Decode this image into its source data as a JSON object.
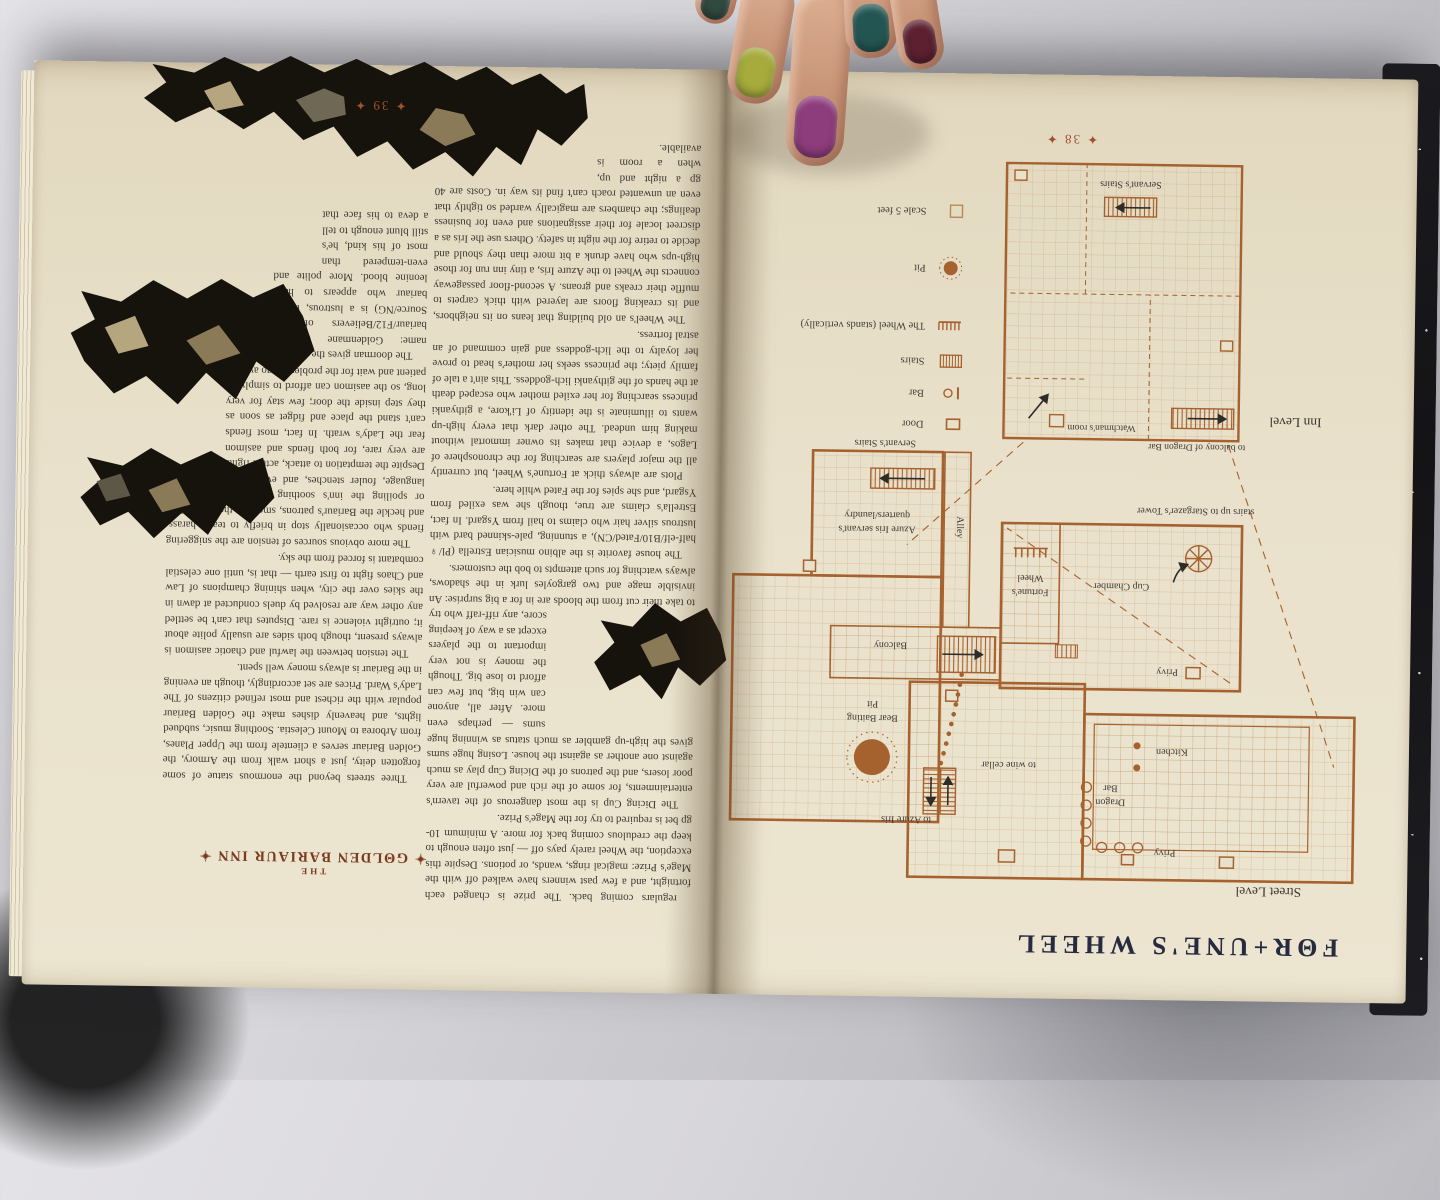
{
  "colors": {
    "page": "#e9e1cb",
    "map_ink": "#a5612e",
    "title_ink": "#262b40",
    "heading_ink": "#7a3a1f",
    "folio_ink": "#a0512e"
  },
  "page38": {
    "title": "FΘR+UNE'S WHEEL",
    "folio": "✦ 38 ✦",
    "street_map": {
      "caption": "Street Level",
      "labels": {
        "privy_top": "Privy",
        "kitchen": "Kitchen",
        "dragon_1": "Dragon",
        "dragon_2": "Bar",
        "wine_cellar": "to wine cellar",
        "azure_iris": "to Azure Iris",
        "bear_1": "Bear Baiting",
        "bear_2": "Pit",
        "balcony": "Balcony",
        "fw_1": "Fortune's",
        "fw_2": "Wheel",
        "cup": "Cup Chamber",
        "privy_bottom": "Privy",
        "alley": "Alley",
        "stargazer": "stairs up to Stargazer's Tower",
        "azure_q1": "Azure Iris servant's",
        "azure_q2": "quarters/laundry",
        "servants_stairs": "Servant's Stairs"
      }
    },
    "inn_map": {
      "caption": "Inn Level",
      "labels": {
        "to_balcony": "to balcony of Dragon Bar",
        "watchman": "Watchman's room",
        "servants_stairs": "Servant's Stairs"
      }
    },
    "legend": {
      "items": [
        {
          "icon": "door-icon",
          "label": "Door"
        },
        {
          "icon": "bar-icon",
          "label": "Bar"
        },
        {
          "icon": "stairs-icon",
          "label": "Stairs"
        },
        {
          "icon": "wheel-icon",
          "label": "The Wheel (stands vertically)"
        },
        {
          "icon": "pit-icon",
          "label": "Pit"
        },
        {
          "icon": "scale-icon",
          "label": "Scale 5 feet"
        }
      ]
    }
  },
  "page39": {
    "folio": "✦ 39 ✦",
    "fortunes_wheel_cont": {
      "p1": "regulars coming back. The prize is changed each fortnight, and a few past winners have walked off with the Mage's Prize: magical rings, wands, or potions. Despite this exception, the Wheel rarely pays off — just often enough to keep the credulous coming back for more. A minimum 10-gp bet is required to try for the Mage's Prize.",
      "p2a": "The Dicing Cup is the most dangerous of the tavern's entertainments, for some of the rich and powerful are very poor losers, and the patrons of the Dicing Cup play as much against one another as against the house. Losing huge sums gives the high-up gambler as much status as winning huge sums",
      "p2b": "— perhaps even more. After all, anyone can win big, but few can afford to lose big. Though the money is not very important to the players except as a way of keeping score, any riff-raff who try to take their cut from the bloods are in for a big surprise: An invisible mage and two gargoyles lurk in the shadows, always watching for such attempts to bob the customers.",
      "p3": "The house favorite is the albino musician Estrella (Pl/♀ half-elf/B10/Fated/CN), a stunning, pale-skinned bard with lustrous silver hair who claims to hail from Ysgard. In fact, Estrella's claims are true, though she was exiled from Ysgard, and she spies for the Fated while here.",
      "p4": "Plots are always thick at Fortune's Wheel, but currently all the major players are searching for the chronosphere of Lagos, a device that makes its owner immortal without making him undead. The other dark that every high-up wants to illuminate is the identity of Li'kore, a githyanki princess searching for her exiled mother who escaped death at the hands of the githyanki lich-goddess. This ain't a tale of family piety; the princess seeks her mother's head to prove her loyalty to the lich-goddess and gain command of an astral fortress.",
      "p5a": "The Wheel's an old building that leans on its neighbors, and its creaking floors are layered with thick carpets to muffle their creaks and groans. A second-floor passageway connects the Wheel to the Azure Iris, a tiny inn run for those high-ups who have drunk a bit more than they should and decide to retire for the night in safety. Others use the Iris as a discreet locale for their assignations and even for business dealings; the chambers are magically warded so tightly that even an unwanted roach can't find its",
      "p5b": "way in. Costs are 40 gp a night and up, when a room is available."
    },
    "golden_bariaur": {
      "heading_small": "THE",
      "heading": "✦ GΘLDEN BARIAUR INN ✦",
      "p1": "Three streets beyond the enormous statue of some forgotten deity, just a short walk from the Armory, the Golden Bariaur serves a clientele from the Upper Planes, from Arborea to Mount Celestia. Soothing music, subdued lights, and heavenly dishes make the Golden Bariaur popular with the richest and most refined citizens of The Lady's Ward. Prices are set accordingly, though an evening in the Bariaur is always money well spent.",
      "p2": "The tension between the lawful and chaotic aasimon is always present, though both sides are usually polite about it; outright violence is rare. Disputes that can't be settled any other way are resolved by duels conducted at dawn in the skies over the city, when shining champions of Law and Chaos fight to first earth — that is, until one celestial combatant is forced from the sky.",
      "p3a": "The more obvious sources of tension are the sniggering fiends who occasionally stop in briefly to tease, harass, and heckle the Bariaur's patrons, smearing them with filth or spoiling the inn's soothing atmosphere with foul language, fouler stenches, and even sulphurous magic. Despite the temptation to attack,",
      "p3b": "actual fights are very rare, for both fiends and aasimon fear the Lady's wrath. In fact, most fiends can't stand the place and fidget as soon as they step inside the door; few stay for very long, so the aasimon can afford to simply be patient and wait for the problem to go away.",
      "p4": "The doorman gives the place its name: Goldenmane (Pl/♂ bariaur/F12/Believers of the Source/NG) is a lustrous, tawny bariaur who appears to have leonine blood. More polite and even-tempered than most of his kind, he's still blunt enough to tell a deva to his face that it's had too much bud and is insulting other patrons. Luckily for Goldenmane, a strong word from him is usually enough to encourage better behavior from the inn's clientele."
    }
  },
  "hand": {
    "nail_colors": [
      "#31493f",
      "#a6ab3c",
      "#8d3c7c",
      "#235652",
      "#5c2030"
    ]
  }
}
